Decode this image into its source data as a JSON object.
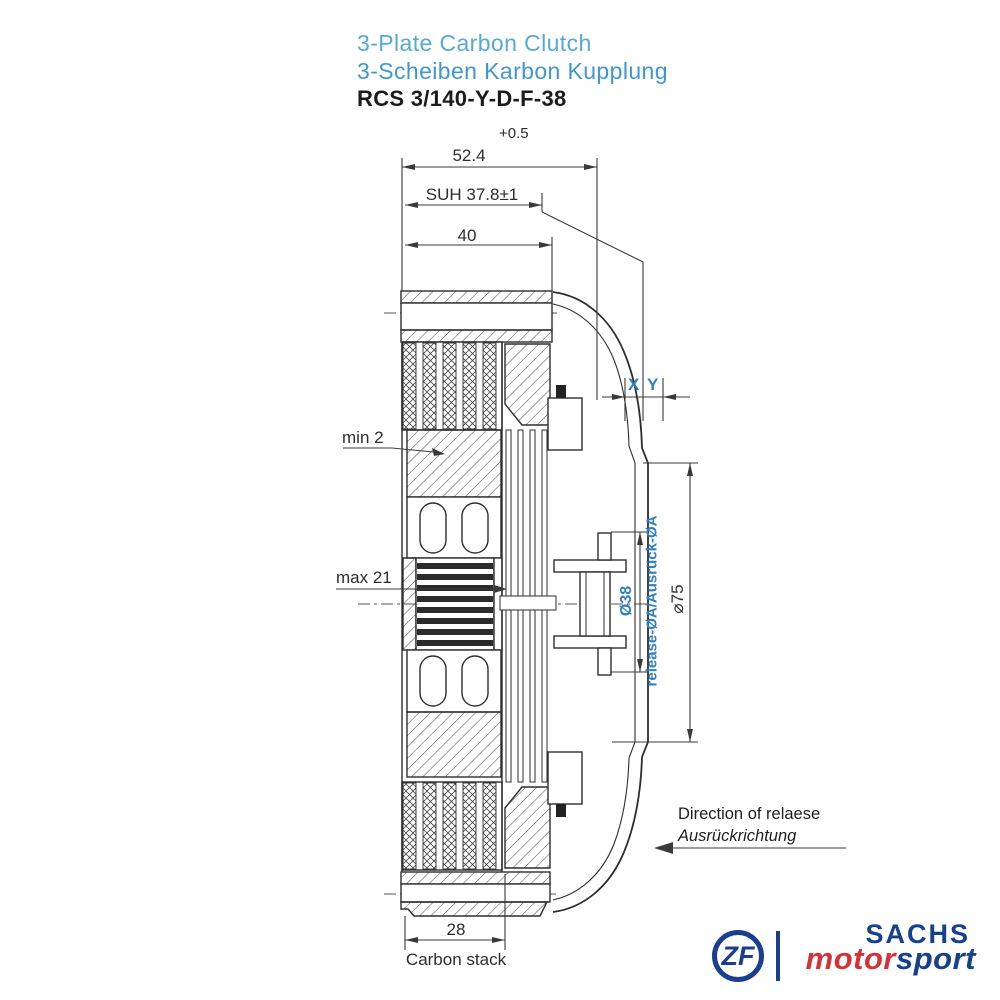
{
  "title": {
    "product_en": "3-Plate Carbon Clutch",
    "product_de": "3-Scheiben Karbon Kupplung",
    "model": "RCS 3/140-Y-D-F-38"
  },
  "annotations": {
    "tolerance": "+0.5",
    "overall_width": "52.4",
    "suh": "SUH 37.8±1",
    "hub_width": "40",
    "min_wear": "min 2",
    "max_wear": "max 21",
    "x_label": "X",
    "y_label": "Y",
    "release_diameter": "Ø38",
    "release_diameter_label": "release-ØA/Ausrück-ØA",
    "outer_diameter": "⌀75",
    "carbon_stack_width": "28",
    "carbon_stack_label": "Carbon stack",
    "release_direction_en": "Direction of relaese",
    "release_direction_de": "Ausrückrichtung"
  },
  "branding": {
    "zf": "ZF",
    "sachs": "SACHS",
    "motorsport_part1": "motor",
    "motorsport_part2": "sport"
  },
  "colors": {
    "title_blue_light": "#55a9d8",
    "title_blue": "#3f97d0",
    "annotation_blue": "#2f7fc1",
    "drawing_line": "#2e2e2e",
    "logo_blue": "#1c3e8e",
    "logo_red": "#d53238",
    "background": "#ffffff"
  }
}
